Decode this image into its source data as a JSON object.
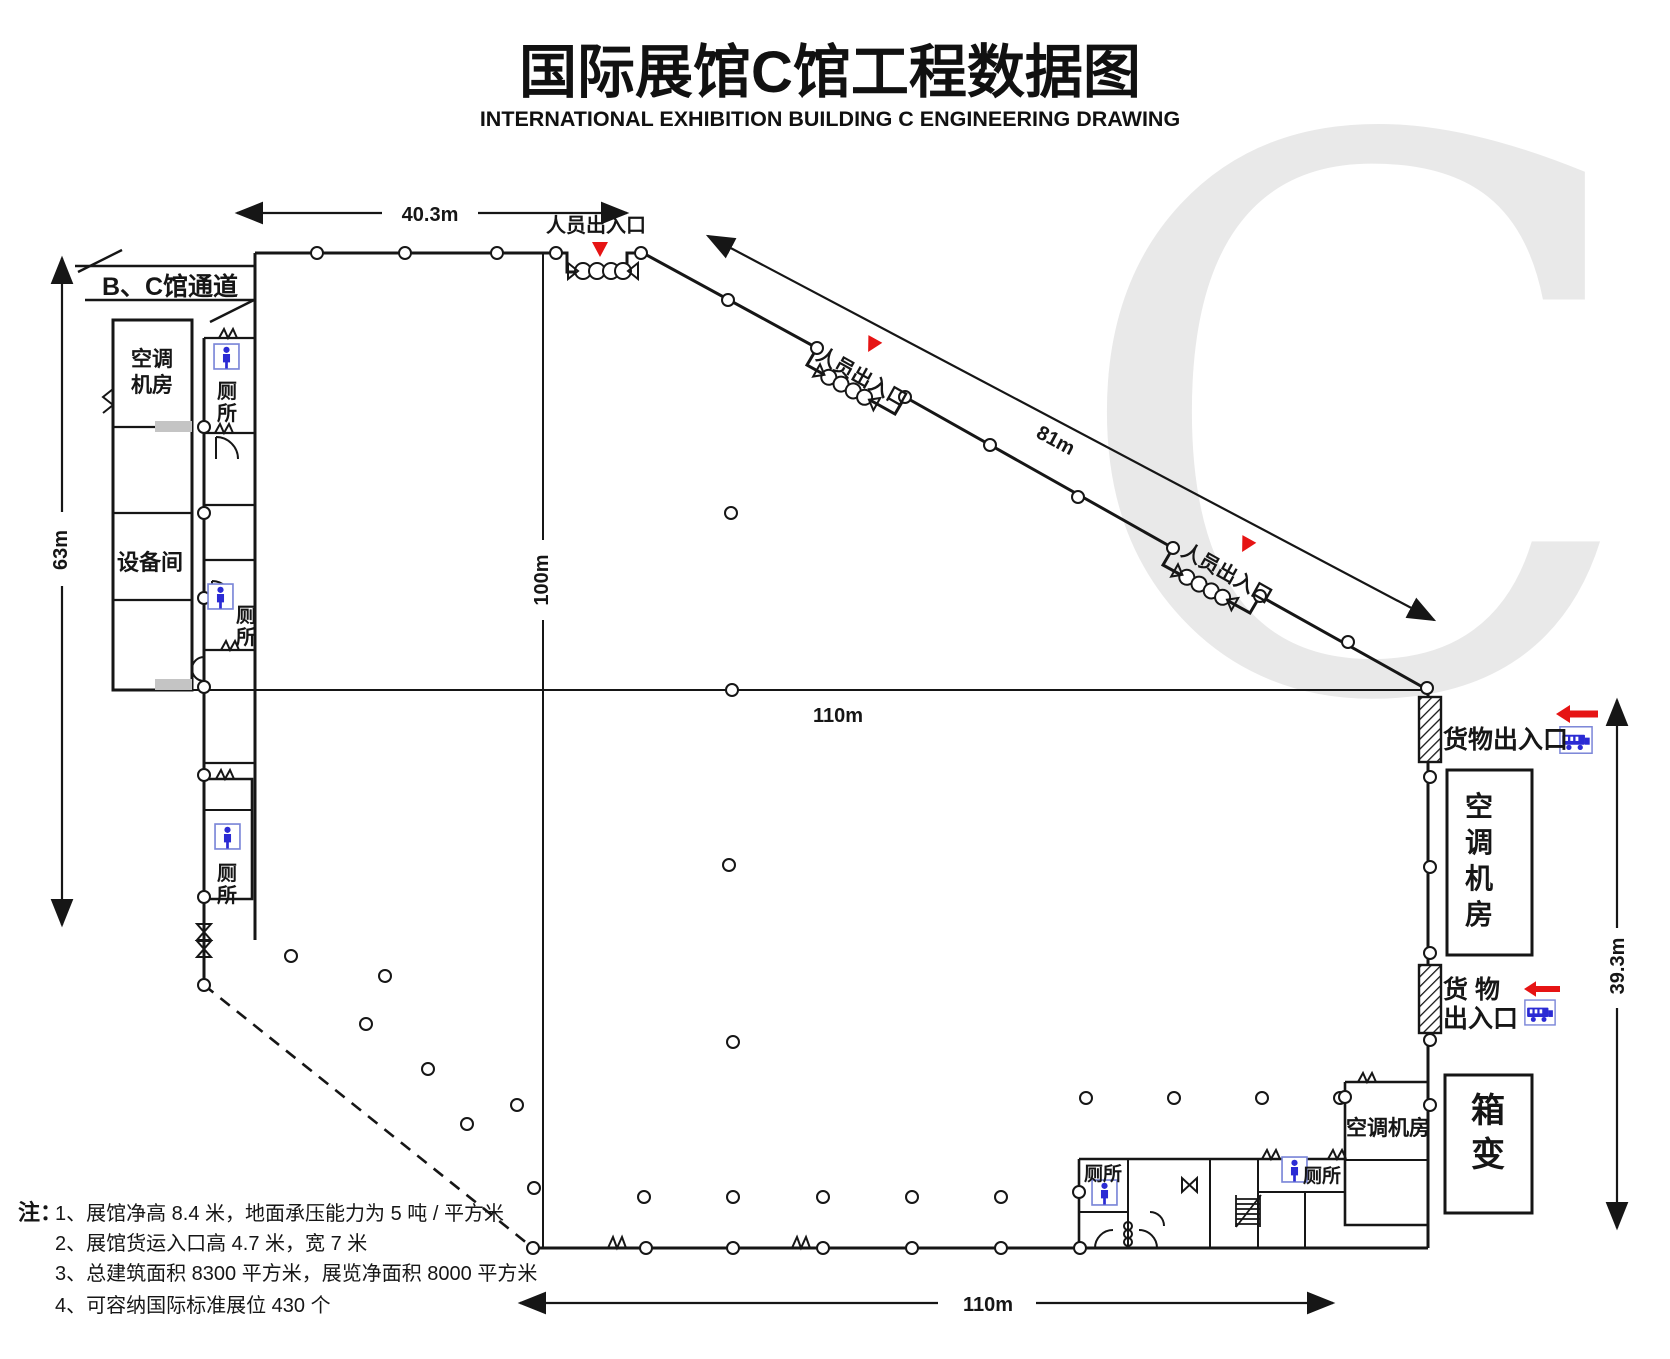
{
  "title": {
    "main": "国际展馆C馆工程数据图",
    "subtitle": "INTERNATIONAL EXHIBITION BUILDING C  ENGINEERING DRAWING"
  },
  "watermark": "C",
  "colors": {
    "line": "#161616",
    "accent_red": "#e61414",
    "icon_blue": "#2b2bd4",
    "icon_border": "#7b86d8",
    "watermark_gray": "#e9e9e9",
    "vent_gray": "#c4c4c4"
  },
  "dimensions": {
    "top_width": "40.3m",
    "left_height": "63m",
    "inner_height": "100m",
    "mid_width": "110m",
    "diagonal_length": "81m",
    "right_height": "39.3m",
    "bottom_width": "110m"
  },
  "labels": {
    "passage_bc": "B、C馆通道",
    "person_entrance": "人员出入口",
    "cargo_entrance": "货物出入口",
    "cargo_line1": "货  物",
    "cargo_line2": "出入口",
    "ac_machine_room": "空调机房",
    "ac_line1": "空调",
    "ac_line2": "机房",
    "ac_chars": [
      "空",
      "调",
      "机",
      "房"
    ],
    "equipment_room": "设备间",
    "toilet": "厕所",
    "toilet_chars": [
      "厕",
      "所"
    ],
    "box_transformer_chars": [
      "箱",
      "变"
    ]
  },
  "notes": {
    "heading": "注：",
    "items": [
      "1、展馆净高 8.4 米，地面承压能力为 5 吨 / 平方米",
      "2、展馆货运入口高 4.7 米，宽 7 米",
      "3、总建筑面积 8300 平方米，展览净面积 8000 平方米",
      "4、可容纳国际标准展位 430 个"
    ]
  }
}
